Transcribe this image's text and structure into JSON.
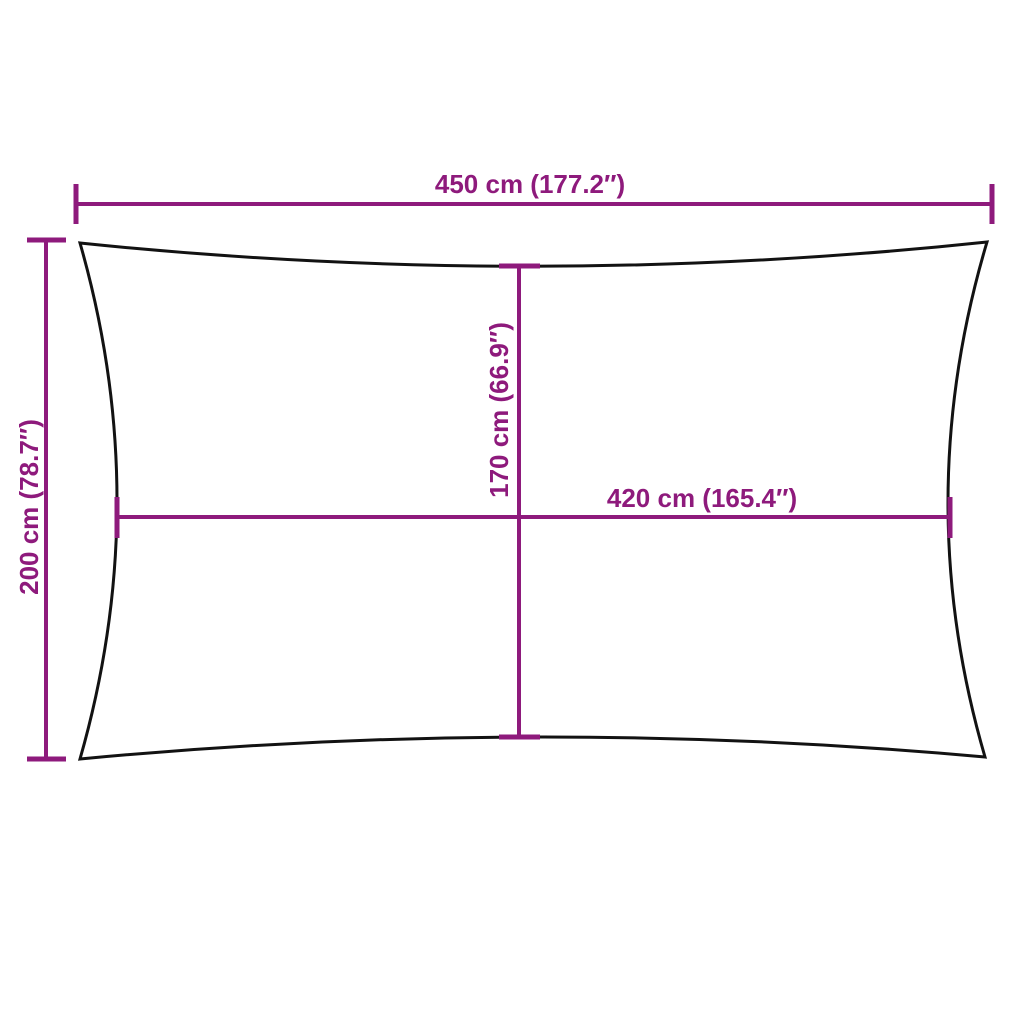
{
  "diagram": {
    "figure": "rectangular shade sail outline with concave edges and dimension arrows",
    "dimensions": {
      "outer_width": {
        "label": "450 cm (177.2″)",
        "cm": 450,
        "inches": 177.2
      },
      "outer_height": {
        "label": "200 cm (78.7″)",
        "cm": 200,
        "inches": 78.7
      },
      "inner_height": {
        "label": "170 cm (66.9″)",
        "cm": 170,
        "inches": 66.9
      },
      "inner_width": {
        "label": "420 cm (165.4″)",
        "cm": 420,
        "inches": 165.4
      }
    },
    "colors": {
      "accent": "#8E1A7C",
      "outline": "#121212",
      "background": "#FFFFFF"
    }
  }
}
